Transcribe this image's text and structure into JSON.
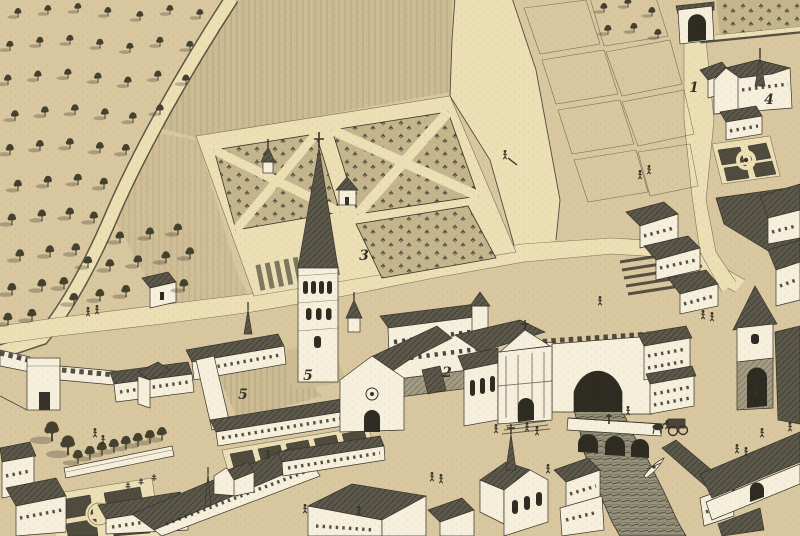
{
  "map": {
    "kind": "engraved-birds-eye-town-view",
    "features": [
      "orchard",
      "formal-garden-parterres",
      "market-garden-plots",
      "abbey-tower-with-spire",
      "abbey-church",
      "cloister",
      "baroque-church-facade",
      "city-wall-crenellated",
      "wall-tower",
      "upper-gate",
      "gate-tower",
      "river",
      "three-arch-bridge",
      "wall-arch-over-river",
      "rowing-boat",
      "horse-cart",
      "town-houses",
      "chapel-with-spire",
      "tree-lined-court",
      "circular-parterre-garden"
    ]
  },
  "labels": {
    "items": [
      {
        "name": "road-label-1",
        "text": "1"
      },
      {
        "name": "building-label-2",
        "text": "2"
      },
      {
        "name": "garden-label-3",
        "text": "3"
      },
      {
        "name": "church-label-4",
        "text": "4"
      },
      {
        "name": "cloister-label-5a",
        "text": "5"
      },
      {
        "name": "cloister-label-5b",
        "text": "5"
      }
    ]
  },
  "colors": {
    "paper": "#d9c7a0",
    "slope": "#cdbb93",
    "path": "#ecdfb4",
    "wall": "#f5efdc",
    "ink": "#37332a",
    "roof": "#5c594c",
    "roofLight": "#a39b82",
    "tree": "#44412f",
    "river": "#96927c",
    "water": "#56523f",
    "bed": "#c4b58c",
    "hatch": "#8a8266",
    "shadow": "rgba(58,53,40,0.30)"
  }
}
